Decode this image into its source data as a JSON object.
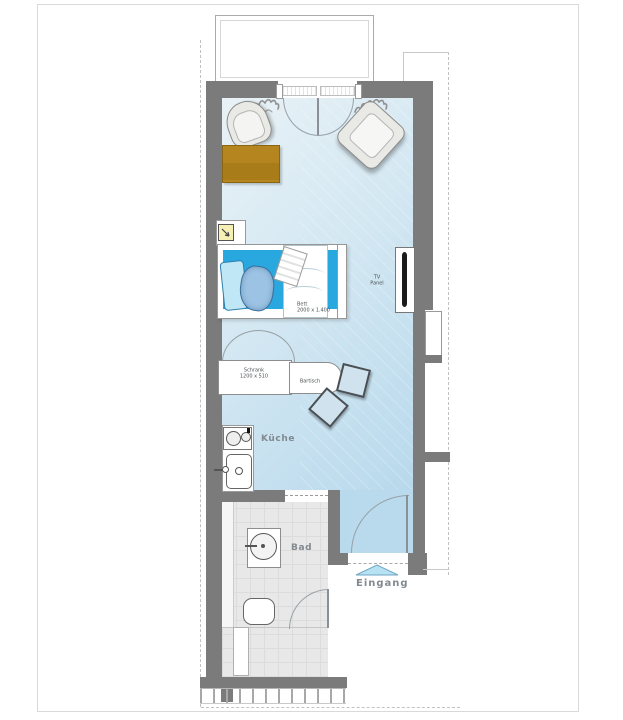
{
  "plan_title": "apartment-floor-plan",
  "rooms": {
    "kitchen_label": "Küche",
    "bath_label": "Bad",
    "entrance_label": "Eingang"
  },
  "furniture": {
    "bed_name": "Bett",
    "bed_dims": "2000 x 1.400",
    "wardrobe_name": "Schrank",
    "wardrobe_dims": "1200 x 510",
    "bar_table_label": "Bartisch",
    "tv_label_line1": "TV",
    "tv_label_line2": "Panel"
  },
  "colors": {
    "wall_gray": "#7b7b7b",
    "floor_blue": "#bedbee",
    "bed_mattress_blue": "#29a8e0",
    "coffee_table_brown": "#b5861f",
    "bath_floor_gray": "#e8e8e8",
    "room_label_gray": "#82898f",
    "entrance_arrow_blue": "#b7e2f4"
  }
}
